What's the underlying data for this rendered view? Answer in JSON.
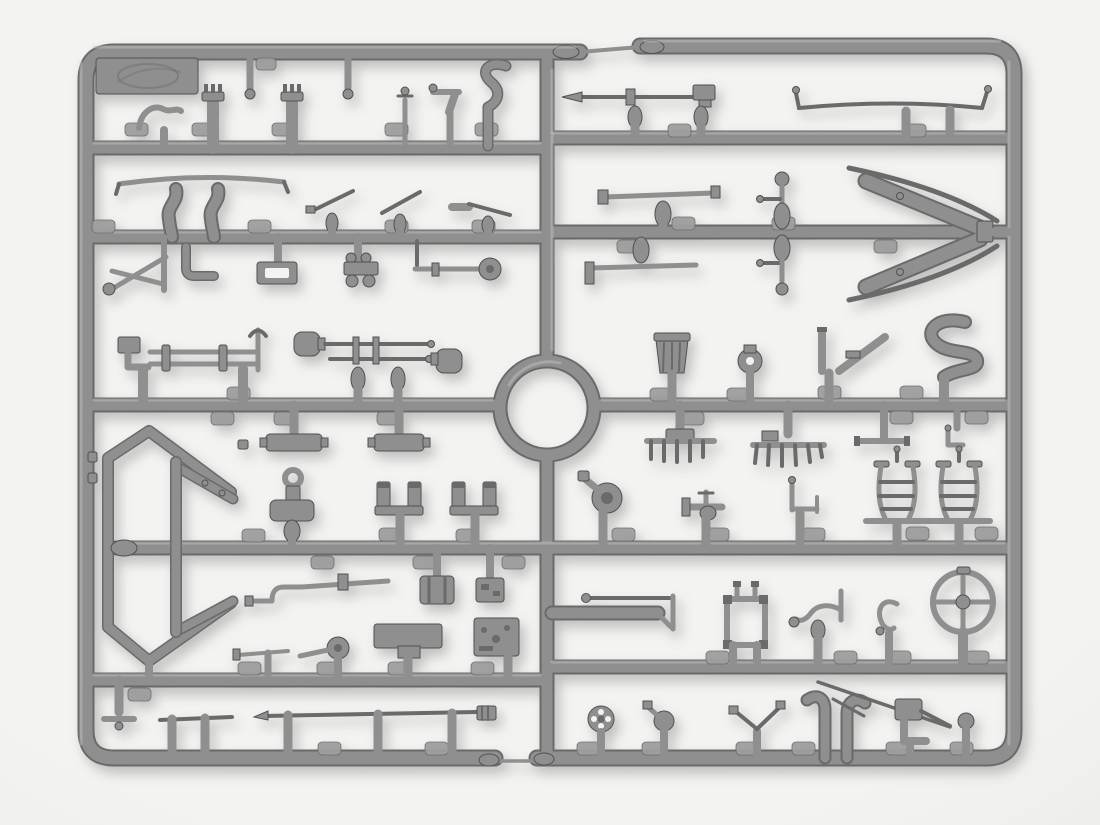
{
  "meta": {
    "type": "photograph",
    "description": "Gray injection-moulded plastic model-kit sprue (runner frame) densely packed with small unpainted accessory parts, photographed on a plain white background.",
    "visible_text": "none legible; embossed manufacturer emblem on the top-left tab and tiny embossed part-number tabs along every runner"
  },
  "colors": {
    "bg": "#f3f3f1",
    "bg_edge": "#e2e2e0",
    "plastic": "#8f8f8f",
    "plastic_light": "#c6c6c6",
    "plastic_dark": "#6a6a6a",
    "plastic_deep": "#515151",
    "tab": "#9e9e9e",
    "shadow": "rgba(40,40,40,0.26)"
  },
  "sprue": {
    "frame": "rounded rectangle split into left and right halves joined by thin break-off rods at top-centre and bottom-centre",
    "center_feature": "circular injection ring in the middle of the central vertical runner",
    "runner_rows": 5,
    "number_tab_count": 45,
    "logo_tab": "embossed oval manufacturer emblem tab in the top-left corner",
    "parts_left": [
      "embossed logo tab",
      "hanging sprue pins (2)",
      "S-hook fitting",
      "capped cylinder posts (2)",
      "pin rod",
      "pistol-grip fitting",
      "curved exhaust pipe",
      "long bow rod",
      "elbow pipes (2)",
      "lever rods (3)",
      "jack tripod",
      "square elbow bracket",
      "buckle plate",
      "axle block with rollers",
      "signal rod with disc",
      "rifle rack with pick",
      "twin dome-capped plunger rods",
      "hanging plates with side tabs (2)",
      "large V shaft frame",
      "strap with eye ring",
      "U-brackets (2)",
      "Z-linkage rod",
      "stowage crate",
      "small equipment box",
      "wide base plate",
      "radio box",
      "crank with disc",
      "short linkage rod",
      "T-foot pin",
      "cleaning rods (2)"
    ],
    "parts_right": [
      "lance with mallet head",
      "swingletree with end hooks",
      "stabilizer bars (2)",
      "ball-top kingpins (2)",
      "large towing arrow with guard rods",
      "ribbed bucket",
      "wheel hub",
      "seat support V",
      "S-curved pipe",
      "manifold rakes (2)",
      "T-bar",
      "L-hook",
      "curved ladders (2)",
      "funnel horn",
      "valve fitting",
      "pin bracket",
      "pipe-and-rod assembly",
      "seat back frame",
      "twisted lever",
      "C-hook",
      "four-spoke handwheel",
      "pierced mini wheel",
      "ball spout",
      "V-rods",
      "elbow pipes (2)",
      "long diagonal rod",
      "box with rod and elbow",
      "ball pin"
    ]
  }
}
